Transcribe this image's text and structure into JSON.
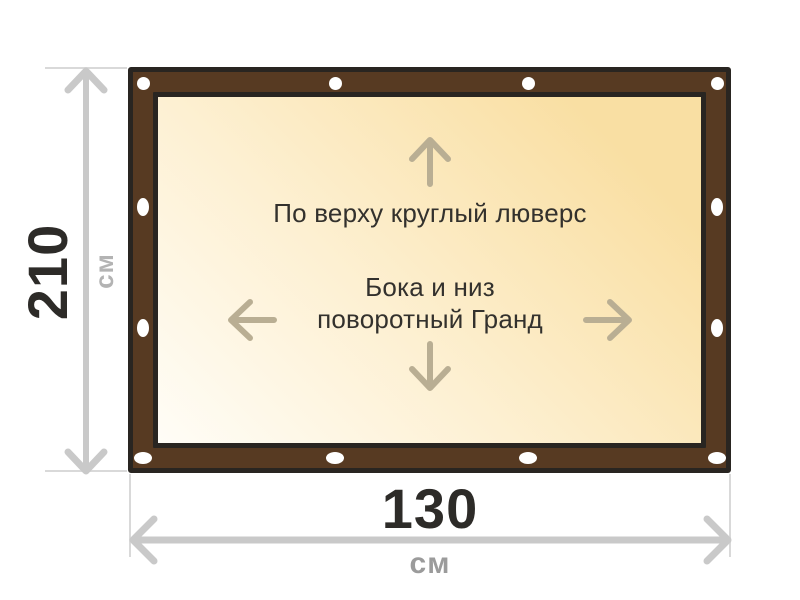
{
  "dimensions": {
    "height": {
      "value": "210",
      "unit": "см"
    },
    "width": {
      "value": "130",
      "unit": "см"
    }
  },
  "annotations": {
    "top": "По верху круглый люверс",
    "middle_line1": "Бока и низ",
    "middle_line2": "поворотный Гранд"
  },
  "colors": {
    "frame_brown": "#573a22",
    "frame_outline": "#292521",
    "canvas_gradient_start": "#fffdf7",
    "canvas_gradient_mid": "#fdf0d2",
    "canvas_gradient_end": "#f9dfa3",
    "inner_arrow": "#b9ae93",
    "dim_line": "#c9c9c9",
    "dim_ext": "#d9d9d9",
    "number_text": "#2d2b28",
    "unit_left": "#b3b3b3",
    "unit_bottom": "#9b9b9b",
    "annotation_text": "#33312d",
    "grommet": "#ffffff",
    "background": "#ffffff"
  }
}
